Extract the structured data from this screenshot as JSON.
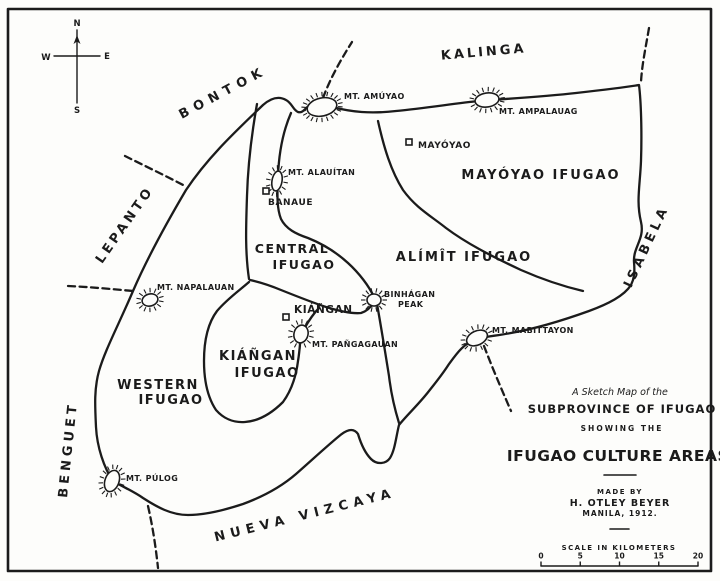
{
  "colors": {
    "ink": "#1b1b1b",
    "paper": "#fdfdfb"
  },
  "compass": {
    "north": "N",
    "east": "E",
    "south": "S",
    "west": "W"
  },
  "title_block": {
    "line1": "A Sketch Map of the",
    "line2": "SUBPROVINCE OF IFUGAO",
    "line3": "SHOWING THE",
    "line4": "IFUGAO CULTURE AREAS",
    "made_by": "MADE BY",
    "author": "H. OTLEY BEYER",
    "place_date": "MANILA, 1912."
  },
  "scale": {
    "caption": "SCALE IN KILOMETERS",
    "ticks": [
      "0",
      "5",
      "10",
      "15",
      "20"
    ]
  },
  "map": {
    "provinces": [
      {
        "id": "kalinga",
        "label": "KALINGA",
        "x": 484,
        "y": 56,
        "rotate": -5,
        "spacing": 3,
        "size": 13.5
      },
      {
        "id": "bontok",
        "label": "BONTOK",
        "x": 225,
        "y": 96,
        "rotate": -28,
        "spacing": 6,
        "size": 13.5
      },
      {
        "id": "lepanto",
        "label": "LEPANTO",
        "x": 128,
        "y": 227,
        "rotate": -55,
        "spacing": 3.5,
        "size": 12.5
      },
      {
        "id": "benguet",
        "label": "BENGUET",
        "x": 72,
        "y": 450,
        "rotate": -84,
        "spacing": 4,
        "size": 13
      },
      {
        "id": "isabela",
        "label": "ISABELA",
        "x": 650,
        "y": 248,
        "rotate": -65,
        "spacing": 4,
        "size": 13
      },
      {
        "id": "nueva-vizcaya",
        "label": "NUEVA VIZCAYA",
        "x": 306,
        "y": 519,
        "rotate": -14,
        "spacing": 5.5,
        "size": 13
      }
    ],
    "regions": [
      {
        "id": "mayoyao-ifugao",
        "lines": [
          {
            "text": "MAYÓYAO IFUGAO",
            "x": 541,
            "y": 179
          }
        ],
        "size": 13,
        "spacing": 2
      },
      {
        "id": "alimit-ifugao",
        "lines": [
          {
            "text": "ALÍMÎT IFUGAO",
            "x": 464,
            "y": 261
          }
        ],
        "size": 13,
        "spacing": 2
      },
      {
        "id": "central-ifugao",
        "lines": [
          {
            "text": "CENTRAL",
            "x": 292,
            "y": 253
          },
          {
            "text": "IFUGAO",
            "x": 304,
            "y": 269
          }
        ],
        "size": 12.5,
        "spacing": 1.5
      },
      {
        "id": "kiangan-ifugao",
        "lines": [
          {
            "text": "KIÁÑGAN",
            "x": 258,
            "y": 360
          },
          {
            "text": "IFUGAO",
            "x": 267,
            "y": 377
          }
        ],
        "size": 13,
        "spacing": 1.5
      },
      {
        "id": "western-ifugao",
        "lines": [
          {
            "text": "WESTERN",
            "x": 158,
            "y": 389
          },
          {
            "text": "IFUGAO",
            "x": 171,
            "y": 404
          }
        ],
        "size": 13,
        "spacing": 1.5
      }
    ],
    "mountains": [
      {
        "id": "mt-amuyao",
        "label": "MT. AMÚYAO",
        "burst": {
          "x": 322,
          "y": 107,
          "rx": 15,
          "ry": 9,
          "rot": -12,
          "n": 22
        },
        "label_x": 344,
        "label_y": 99
      },
      {
        "id": "mt-ampalauag",
        "label": "MT. AMPALAUAG",
        "burst": {
          "x": 487,
          "y": 100,
          "rx": 12,
          "ry": 7,
          "rot": -8,
          "n": 18
        },
        "label_x": 499,
        "label_y": 114
      },
      {
        "id": "mt-alauitan",
        "label": "MT. ALAUÍTAN",
        "burst": {
          "x": 277,
          "y": 181,
          "rx": 5,
          "ry": 10,
          "rot": 10,
          "n": 14
        },
        "label_x": 288,
        "label_y": 175
      },
      {
        "id": "mt-napalauan",
        "label": "MT. NAPALAUAN",
        "burst": {
          "x": 150,
          "y": 300,
          "rx": 8,
          "ry": 6,
          "rot": -15,
          "n": 14
        },
        "label_x": 157,
        "label_y": 290
      },
      {
        "id": "binhagan-peak",
        "label": "BINHÁGAN",
        "label2": "PEAK",
        "label2_x": 398,
        "label2_y": 307,
        "burst": {
          "x": 374,
          "y": 300,
          "rx": 7,
          "ry": 6,
          "rot": 0,
          "n": 14
        },
        "label_x": 384,
        "label_y": 297
      },
      {
        "id": "mt-pangagauan",
        "label": "MT. PAÑGAGAUAN",
        "burst": {
          "x": 301,
          "y": 334,
          "rx": 7,
          "ry": 9,
          "rot": 15,
          "n": 14
        },
        "label_x": 312,
        "label_y": 347
      },
      {
        "id": "mt-mabittayon",
        "label": "MT. MABITTAYON",
        "burst": {
          "x": 477,
          "y": 338,
          "rx": 11,
          "ry": 7,
          "rot": -25,
          "n": 16
        },
        "label_x": 492,
        "label_y": 333
      },
      {
        "id": "mt-pulog",
        "label": "MT. PÚLOG",
        "burst": {
          "x": 112,
          "y": 481,
          "rx": 7,
          "ry": 11,
          "rot": 20,
          "n": 16
        },
        "label_x": 126,
        "label_y": 481
      }
    ],
    "towns": [
      {
        "id": "mayoyao-town",
        "label": "MAYÓYAO",
        "sq_x": 409,
        "sq_y": 142,
        "label_x": 418,
        "label_y": 148,
        "size": 9
      },
      {
        "id": "banaue-town",
        "label": "BANAUE",
        "sq_x": 266,
        "sq_y": 191,
        "label_x": 268,
        "label_y": 205,
        "size": 9
      },
      {
        "id": "kiangan-town",
        "label": "KIÁÑGAN",
        "sq_x": 286,
        "sq_y": 317,
        "label_x": 294,
        "label_y": 313,
        "size": 10.5
      }
    ]
  }
}
